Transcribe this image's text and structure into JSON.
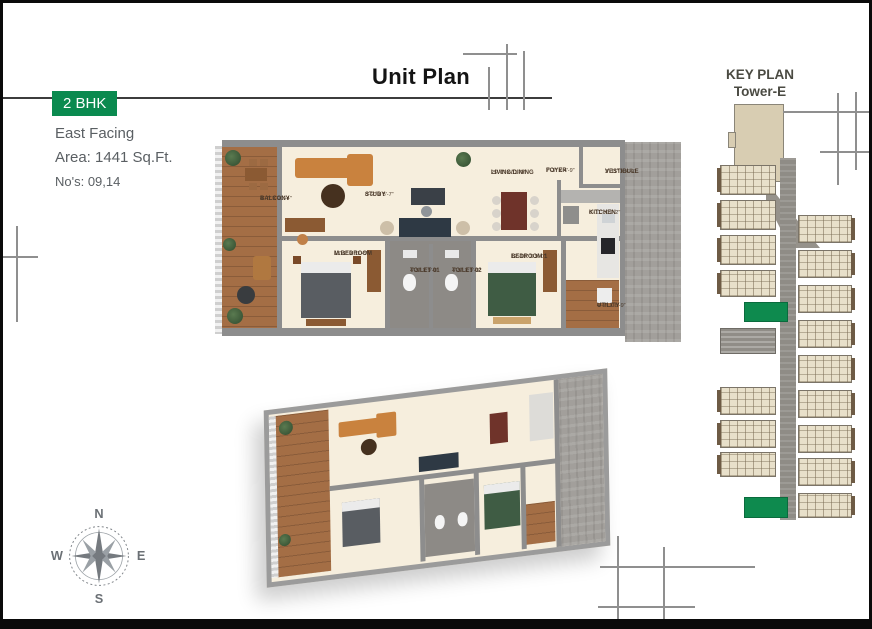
{
  "page": {
    "title": "Unit Plan"
  },
  "unit_info": {
    "type_badge": "2 BHK",
    "facing": "East Facing",
    "area": "Area: 1441 Sq.Ft.",
    "unit_numbers": "No's: 09,14",
    "badge_color": "#0A8A4F"
  },
  "key_plan": {
    "title": "KEY PLAN",
    "subtitle": "Tower-E",
    "highlight_color": "#0E8A4E"
  },
  "compass": {
    "north": "N",
    "east": "E",
    "south": "S",
    "west": "W"
  },
  "floor_plan": {
    "rooms": [
      {
        "name": "BALCONY",
        "dims": "4'-7\" X 21'-4\""
      },
      {
        "name": "STUDY",
        "dims": "8'-2\" X 8'-7\""
      },
      {
        "name": "LIVING/DINING",
        "dims": "25'-0\" X 11'-0\""
      },
      {
        "name": "FOYER",
        "dims": "7'-3\" X 4'-9\""
      },
      {
        "name": "VESTIBULE",
        "dims": "3'-11\" X 4'-9\""
      },
      {
        "name": "KITCHEN",
        "dims": "6'-11\" X 9'-2\""
      },
      {
        "name": "M.BEDROOM",
        "dims": "13'-1\" X 11'-5\""
      },
      {
        "name": "TOILET 01",
        "dims": "4'-5\" X 9'-0\""
      },
      {
        "name": "TOILET 02",
        "dims": "4'-5\" X 9'-0\""
      },
      {
        "name": "BEDROOM 1",
        "dims": "12'-10\" X 9'-0\""
      },
      {
        "name": "UTILITY",
        "dims": "4'-7\" X 8'-9\""
      }
    ]
  }
}
